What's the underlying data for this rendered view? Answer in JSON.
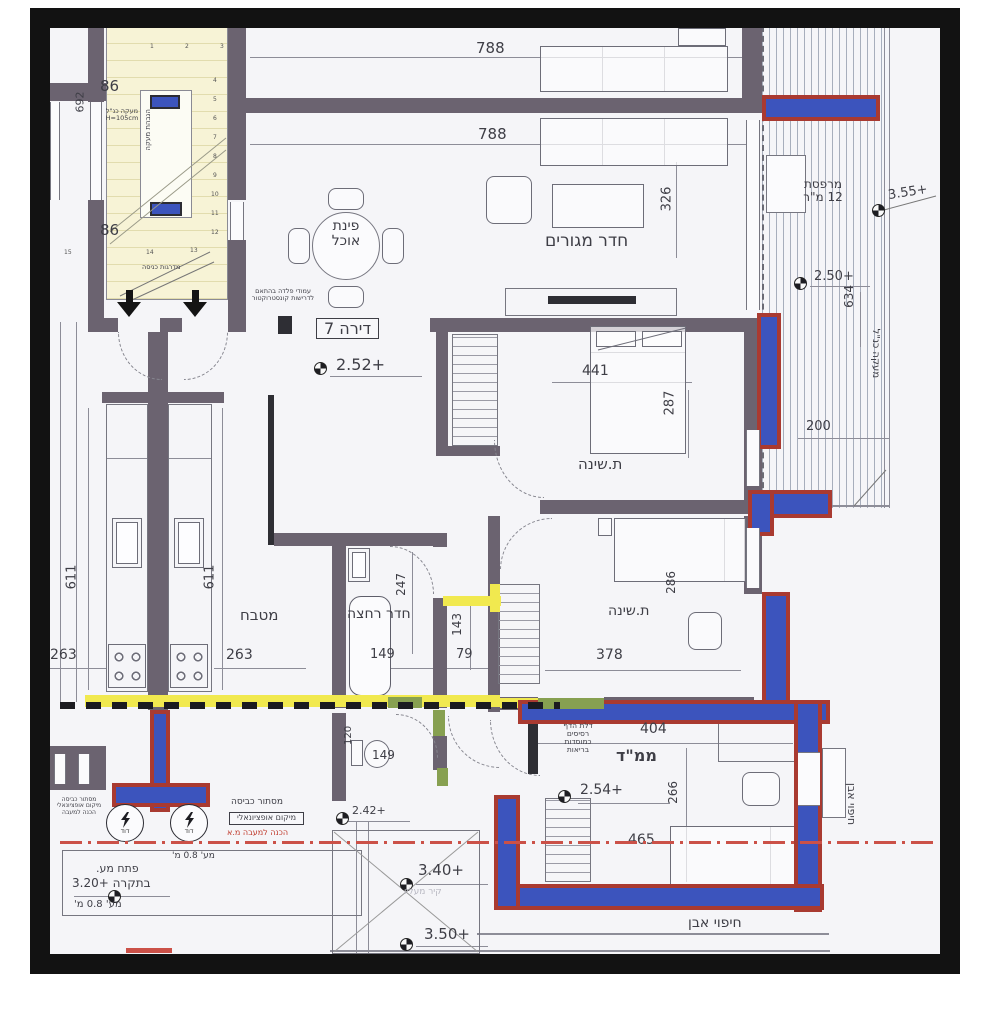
{
  "drawing": {
    "boiler_label": "דוד",
    "colors": {
      "wall": "#6b6370",
      "reinforced_wall_fill": "#3c54bd",
      "reinforced_wall_outline": "#a93a31",
      "demolition_highlight": "#f1e94f",
      "door_jamb_green": "#87a051",
      "center_line_red": "#cb5148",
      "stair_fill": "#f7f3d6"
    },
    "labels": [
      {
        "n": "dim-788-top",
        "t": "788",
        "x": 476,
        "y": 40,
        "fs": 15
      },
      {
        "n": "dim-788-mid",
        "t": "788",
        "x": 478,
        "y": 126,
        "fs": 15
      },
      {
        "n": "dim-326",
        "t": "326",
        "x": 655,
        "y": 192,
        "fs": 13,
        "rot": -90
      },
      {
        "n": "room-living",
        "t": "חדר מגורים",
        "x": 545,
        "y": 232,
        "fs": 17
      },
      {
        "n": "room-dining",
        "t": "פינת\nאוכל",
        "x": 313,
        "y": 219,
        "fs": 14,
        "w": 66,
        "ctr": 1
      },
      {
        "n": "apartment-box",
        "t": "דירה 7",
        "x": 316,
        "y": 318,
        "fs": 16,
        "box": 1
      },
      {
        "n": "elev-2-52",
        "t": "+2.52",
        "x": 336,
        "y": 356,
        "fs": 16
      },
      {
        "n": "room-balcony",
        "t": "מרפסת\n12 מ\"ר",
        "x": 792,
        "y": 178,
        "fs": 12,
        "w": 62,
        "ctr": 1
      },
      {
        "n": "elev-3-55",
        "t": "+3.55",
        "x": 888,
        "y": 186,
        "fs": 13,
        "rot": -9
      },
      {
        "n": "elev-2-50",
        "t": "+2.50",
        "x": 814,
        "y": 270,
        "fs": 13
      },
      {
        "n": "dim-634",
        "t": "634",
        "x": 838,
        "y": 290,
        "fs": 12,
        "rot": -90
      },
      {
        "n": "note-railing-balcony",
        "t": "מעקה כנ\"ל",
        "x": 850,
        "y": 348,
        "fs": 10,
        "rot": 90
      },
      {
        "n": "dim-200",
        "t": "200",
        "x": 806,
        "y": 420,
        "fs": 13
      },
      {
        "n": "dim-86-top",
        "t": "86",
        "x": 100,
        "y": 78,
        "fs": 15
      },
      {
        "n": "dim-86-mid",
        "t": "86",
        "x": 100,
        "y": 222,
        "fs": 15
      },
      {
        "n": "dim-692",
        "t": "692",
        "x": 70,
        "y": 96,
        "fs": 11,
        "rot": -90
      },
      {
        "n": "note-railing-stairs",
        "t": "מעקה כנ\"ל\nH=105cm",
        "x": 102,
        "y": 108,
        "fs": 6.5,
        "w": 40,
        "ctr": 1
      },
      {
        "n": "note-stair-strip",
        "t": "הגבהת מעקה",
        "x": 128,
        "y": 126,
        "fs": 7,
        "rot": -90
      },
      {
        "n": "note-entry-stairs",
        "t": "מדרגות כניסה",
        "x": 142,
        "y": 264,
        "fs": 6.5
      },
      {
        "n": "note-steel-columns",
        "t": "עמודי פלדה בהתאם\nלדרישות קונסטרוקטור",
        "x": 240,
        "y": 288,
        "fs": 6.5,
        "w": 86,
        "ctr": 1
      },
      {
        "n": "dim-441",
        "t": "441",
        "x": 582,
        "y": 364,
        "fs": 14
      },
      {
        "n": "dim-287",
        "t": "287",
        "x": 658,
        "y": 396,
        "fs": 13,
        "rot": -90
      },
      {
        "n": "room-bed1",
        "t": "ת.שינה",
        "x": 578,
        "y": 456,
        "fs": 15
      },
      {
        "n": "dim-247",
        "t": "247",
        "x": 390,
        "y": 578,
        "fs": 12,
        "rot": -90
      },
      {
        "n": "room-bath",
        "t": "חדר רחצה",
        "x": 347,
        "y": 607,
        "fs": 14
      },
      {
        "n": "dim-149-bath",
        "t": "149",
        "x": 370,
        "y": 648,
        "fs": 13
      },
      {
        "n": "dim-143",
        "t": "143",
        "x": 446,
        "y": 618,
        "fs": 12,
        "rot": -90
      },
      {
        "n": "dim-79",
        "t": "79",
        "x": 456,
        "y": 648,
        "fs": 13
      },
      {
        "n": "room-kitchen",
        "t": "מטבח",
        "x": 240,
        "y": 607,
        "fs": 15
      },
      {
        "n": "dim-611-right",
        "t": "611",
        "x": 198,
        "y": 570,
        "fs": 13,
        "rot": -90
      },
      {
        "n": "dim-263-right",
        "t": "263",
        "x": 226,
        "y": 648,
        "fs": 14
      },
      {
        "n": "dim-611-left",
        "t": "611",
        "x": 60,
        "y": 570,
        "fs": 13,
        "rot": -90
      },
      {
        "n": "dim-263-left",
        "t": "263",
        "x": 50,
        "y": 648,
        "fs": 14
      },
      {
        "n": "dim-286",
        "t": "286",
        "x": 660,
        "y": 576,
        "fs": 12,
        "rot": -90
      },
      {
        "n": "room-bed2",
        "t": "ת.שינה",
        "x": 608,
        "y": 604,
        "fs": 14
      },
      {
        "n": "dim-378",
        "t": "378",
        "x": 596,
        "y": 648,
        "fs": 14
      },
      {
        "n": "dim-404",
        "t": "404",
        "x": 640,
        "y": 722,
        "fs": 14
      },
      {
        "n": "room-mamad",
        "t": "ממ\"ד",
        "x": 616,
        "y": 747,
        "fs": 16,
        "bold": 1
      },
      {
        "n": "note-blast-door",
        "t": "דלת הדף\nרסיסים\nכמוסדות\nבריאות",
        "x": 546,
        "y": 722,
        "fs": 7.5,
        "w": 64,
        "ctr": 1
      },
      {
        "n": "elev-2-54",
        "t": "+2.54",
        "x": 580,
        "y": 783,
        "fs": 14
      },
      {
        "n": "dim-266",
        "t": "266",
        "x": 662,
        "y": 786,
        "fs": 12,
        "rot": -90
      },
      {
        "n": "dim-465",
        "t": "465",
        "x": 628,
        "y": 833,
        "fs": 14
      },
      {
        "n": "note-stone-bottom",
        "t": "חיפוי אבן",
        "x": 688,
        "y": 916,
        "fs": 14
      },
      {
        "n": "note-stone-right",
        "t": "חיפוי אבן",
        "x": 830,
        "y": 798,
        "fs": 11,
        "rot": 90
      },
      {
        "n": "note-laundry",
        "t": "מסתור כביסה",
        "x": 231,
        "y": 798,
        "fs": 9
      },
      {
        "n": "note-optional-loc",
        "t": "מיקום אופציונאלי",
        "x": 229,
        "y": 812,
        "fs": 8,
        "box": 1
      },
      {
        "n": "note-condenser",
        "t": "הכנה למעבה מ.א",
        "x": 227,
        "y": 829,
        "fs": 8,
        "c": "#c0392b"
      },
      {
        "n": "note-laundry-left",
        "t": "מסתור כביסה\nמיקום אופציונאלי\nהכנה למעבה",
        "x": 50,
        "y": 797,
        "fs": 6,
        "w": 58,
        "ctr": 1
      },
      {
        "n": "elev-2-42",
        "t": "+2.42",
        "x": 352,
        "y": 805,
        "fs": 11
      },
      {
        "n": "dim-149-wc",
        "t": "149",
        "x": 372,
        "y": 749,
        "fs": 12
      },
      {
        "n": "dim-120",
        "t": "120",
        "x": 340,
        "y": 730,
        "fs": 10,
        "rot": -90
      },
      {
        "n": "note-guardrail-top",
        "t": "מע' 0.8 מ'",
        "x": 172,
        "y": 852,
        "fs": 9
      },
      {
        "n": "note-ceiling-opening",
        "t": "פתח מע.",
        "x": 96,
        "y": 863,
        "fs": 11
      },
      {
        "n": "elev-3-20",
        "t": "בתקרה +3.20",
        "x": 72,
        "y": 877,
        "fs": 12
      },
      {
        "n": "note-guardrail-bottom",
        "t": "מע' 0.8 מ'",
        "x": 74,
        "y": 900,
        "fs": 10
      },
      {
        "n": "elev-3-40",
        "t": "+3.40",
        "x": 418,
        "y": 862,
        "fs": 15
      },
      {
        "n": "note-wall-above",
        "t": "קיר מעליו",
        "x": 404,
        "y": 888,
        "fs": 9,
        "c": "#b8b8c2"
      },
      {
        "n": "elev-3-50",
        "t": "+3.50",
        "x": 424,
        "y": 926,
        "fs": 15
      },
      {
        "n": "stair-step",
        "t": "1",
        "x": 150,
        "y": 44,
        "fs": 6,
        "c": "#555"
      },
      {
        "n": "stair-step",
        "t": "2",
        "x": 185,
        "y": 44,
        "fs": 6,
        "c": "#555"
      },
      {
        "n": "stair-step",
        "t": "3",
        "x": 220,
        "y": 44,
        "fs": 6,
        "c": "#555"
      },
      {
        "n": "stair-step",
        "t": "4",
        "x": 213,
        "y": 78,
        "fs": 6,
        "c": "#555"
      },
      {
        "n": "stair-step",
        "t": "5",
        "x": 213,
        "y": 97,
        "fs": 6,
        "c": "#555"
      },
      {
        "n": "stair-step",
        "t": "6",
        "x": 213,
        "y": 116,
        "fs": 6,
        "c": "#555"
      },
      {
        "n": "stair-step",
        "t": "7",
        "x": 213,
        "y": 135,
        "fs": 6,
        "c": "#555"
      },
      {
        "n": "stair-step",
        "t": "8",
        "x": 213,
        "y": 154,
        "fs": 6,
        "c": "#555"
      },
      {
        "n": "stair-step",
        "t": "9",
        "x": 213,
        "y": 173,
        "fs": 6,
        "c": "#555"
      },
      {
        "n": "stair-step",
        "t": "10",
        "x": 211,
        "y": 192,
        "fs": 6,
        "c": "#555"
      },
      {
        "n": "stair-step",
        "t": "11",
        "x": 211,
        "y": 211,
        "fs": 6,
        "c": "#555"
      },
      {
        "n": "stair-step",
        "t": "12",
        "x": 211,
        "y": 230,
        "fs": 6,
        "c": "#555"
      },
      {
        "n": "stair-step",
        "t": "13",
        "x": 190,
        "y": 248,
        "fs": 6,
        "c": "#555"
      },
      {
        "n": "stair-step",
        "t": "14",
        "x": 146,
        "y": 250,
        "fs": 6,
        "c": "#555"
      },
      {
        "n": "stair-step",
        "t": "15",
        "x": 64,
        "y": 250,
        "fs": 6,
        "c": "#555"
      }
    ]
  }
}
